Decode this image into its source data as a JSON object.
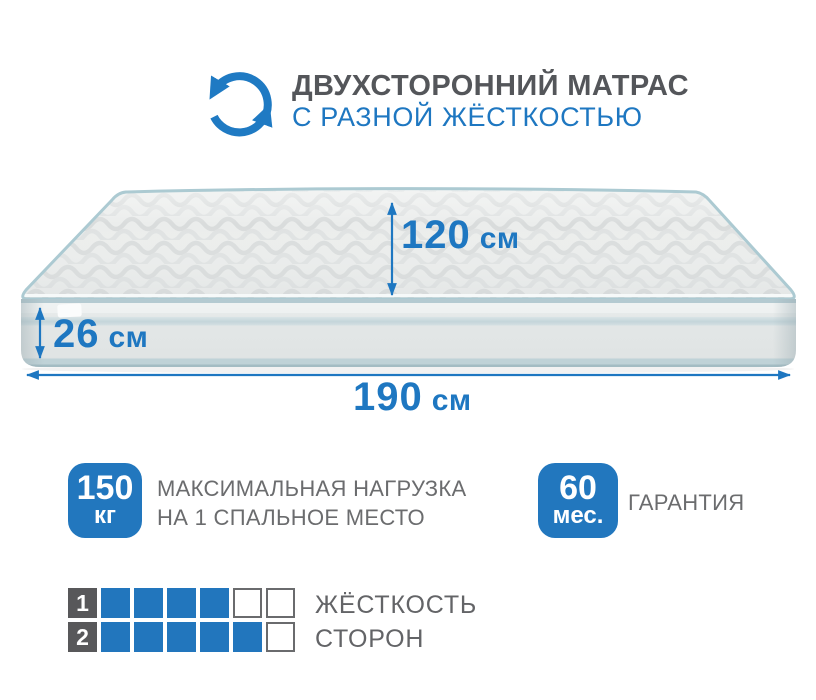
{
  "header": {
    "icon": "two-sided-rotate-icon",
    "title": "ДВУХСТОРОННИЙ МАТРАС",
    "subtitle": "С РАЗНОЙ ЖЁСТКОСТЬЮ"
  },
  "dimensions": {
    "depth": {
      "value": "120",
      "unit": "см"
    },
    "height": {
      "value": "26",
      "unit": "см"
    },
    "length": {
      "value": "190",
      "unit": "см"
    }
  },
  "badges": [
    {
      "value": "150",
      "unit": "кг",
      "label_line1": "МАКСИМАЛЬНАЯ НАГРУЗКА",
      "label_line2": "НА 1 СПАЛЬНОЕ МЕСТО"
    },
    {
      "value": "60",
      "unit": "мес.",
      "label_line1": "ГАРАНТИЯ"
    }
  ],
  "hardness": {
    "label_line1": "ЖЁСТКОСТЬ",
    "label_line2": "СТОРОН",
    "rows": [
      {
        "side": "1",
        "filled": 4,
        "total": 6
      },
      {
        "side": "2",
        "filled": 5,
        "total": 6
      }
    ]
  },
  "colors": {
    "accent_blue": "#1e77c1",
    "badge_blue": "#2277be",
    "square_blue": "#2276bd",
    "dark_gray": "#58585a",
    "text_gray": "#6b6c6e",
    "piping_blue": "#accad2",
    "mattress_light": "#ebedec"
  }
}
